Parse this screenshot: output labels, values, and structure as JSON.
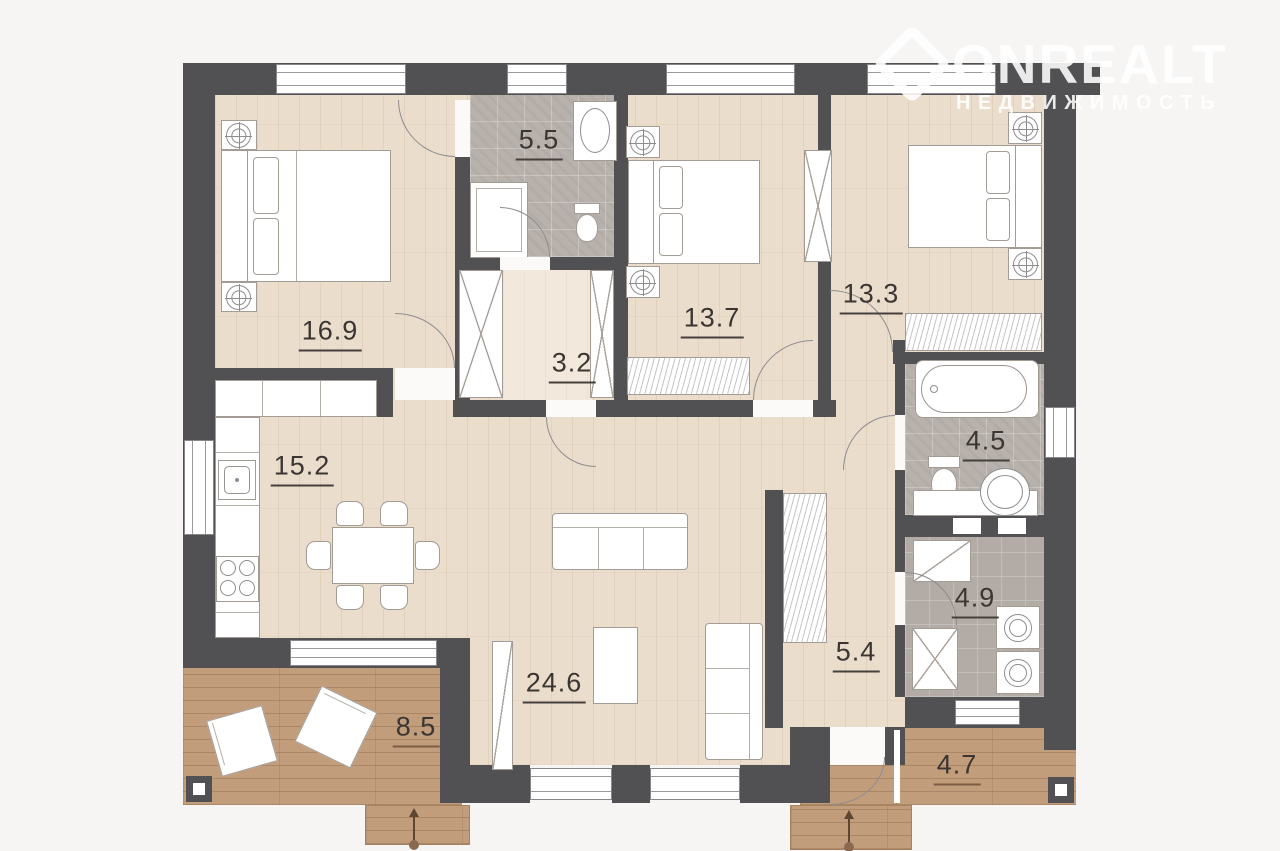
{
  "watermark": {
    "brand": "ONREALT",
    "tagline": "НЕДВИЖИМОСТЬ"
  },
  "rooms": [
    {
      "id": "bedroom-1",
      "area": "16.9"
    },
    {
      "id": "bathroom-1",
      "area": "5.5"
    },
    {
      "id": "bedroom-2",
      "area": "13.7"
    },
    {
      "id": "bedroom-3",
      "area": "13.3"
    },
    {
      "id": "closet",
      "area": "3.2"
    },
    {
      "id": "kitchen",
      "area": "15.2"
    },
    {
      "id": "bathroom-2",
      "area": "4.5"
    },
    {
      "id": "laundry",
      "area": "4.9"
    },
    {
      "id": "hallway",
      "area": "5.4"
    },
    {
      "id": "living-room",
      "area": "24.6"
    },
    {
      "id": "terrace",
      "area": "8.5"
    },
    {
      "id": "porch",
      "area": "4.7"
    }
  ],
  "colors": {
    "wall": "#515153",
    "wood": "#ebddcb",
    "tile": "#b8b1ac",
    "deck": "#c19d7c",
    "background": "#f6f5f3"
  }
}
